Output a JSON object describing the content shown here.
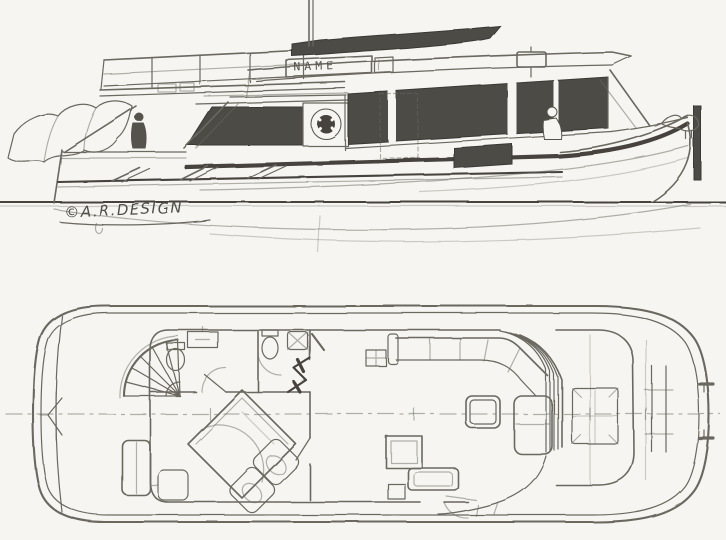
{
  "colors": {
    "paper": "#f6f5f1",
    "pencil": "#6a675f",
    "pencil_dark": "#46433e",
    "shade_fill": "#4e4b45"
  },
  "profile": {
    "name_plate": "NAME",
    "signature": "©A.R.DESIGN"
  }
}
